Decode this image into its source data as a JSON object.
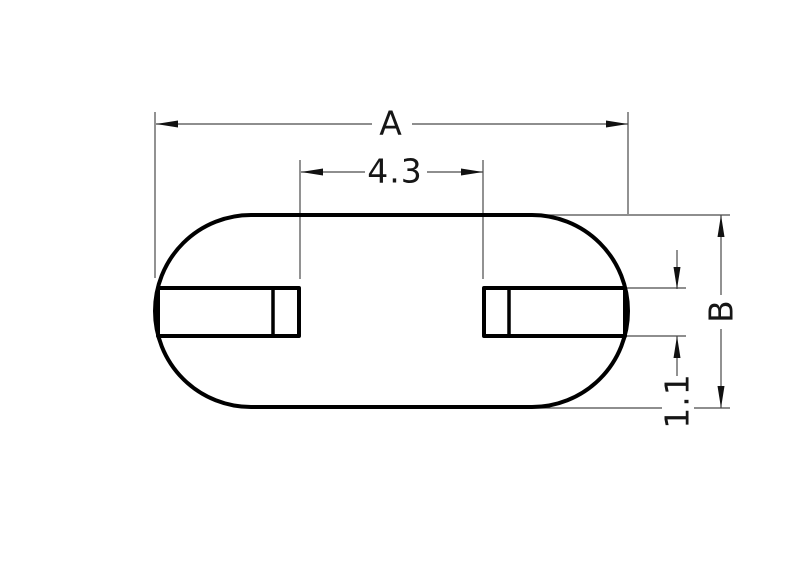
{
  "drawing": {
    "type": "technical-dimension-drawing",
    "part": "obround-plate-with-two-slots",
    "dimensions": {
      "overall_width_label": "A",
      "slot_gap_value": "4.3",
      "overall_height_label": "B",
      "slot_height_value": "1.1"
    },
    "colors": {
      "background": "#ffffff",
      "outline": "#000000",
      "dimension_line": "#4a4a4a",
      "arrow": "#111111",
      "text": "#161616"
    }
  }
}
